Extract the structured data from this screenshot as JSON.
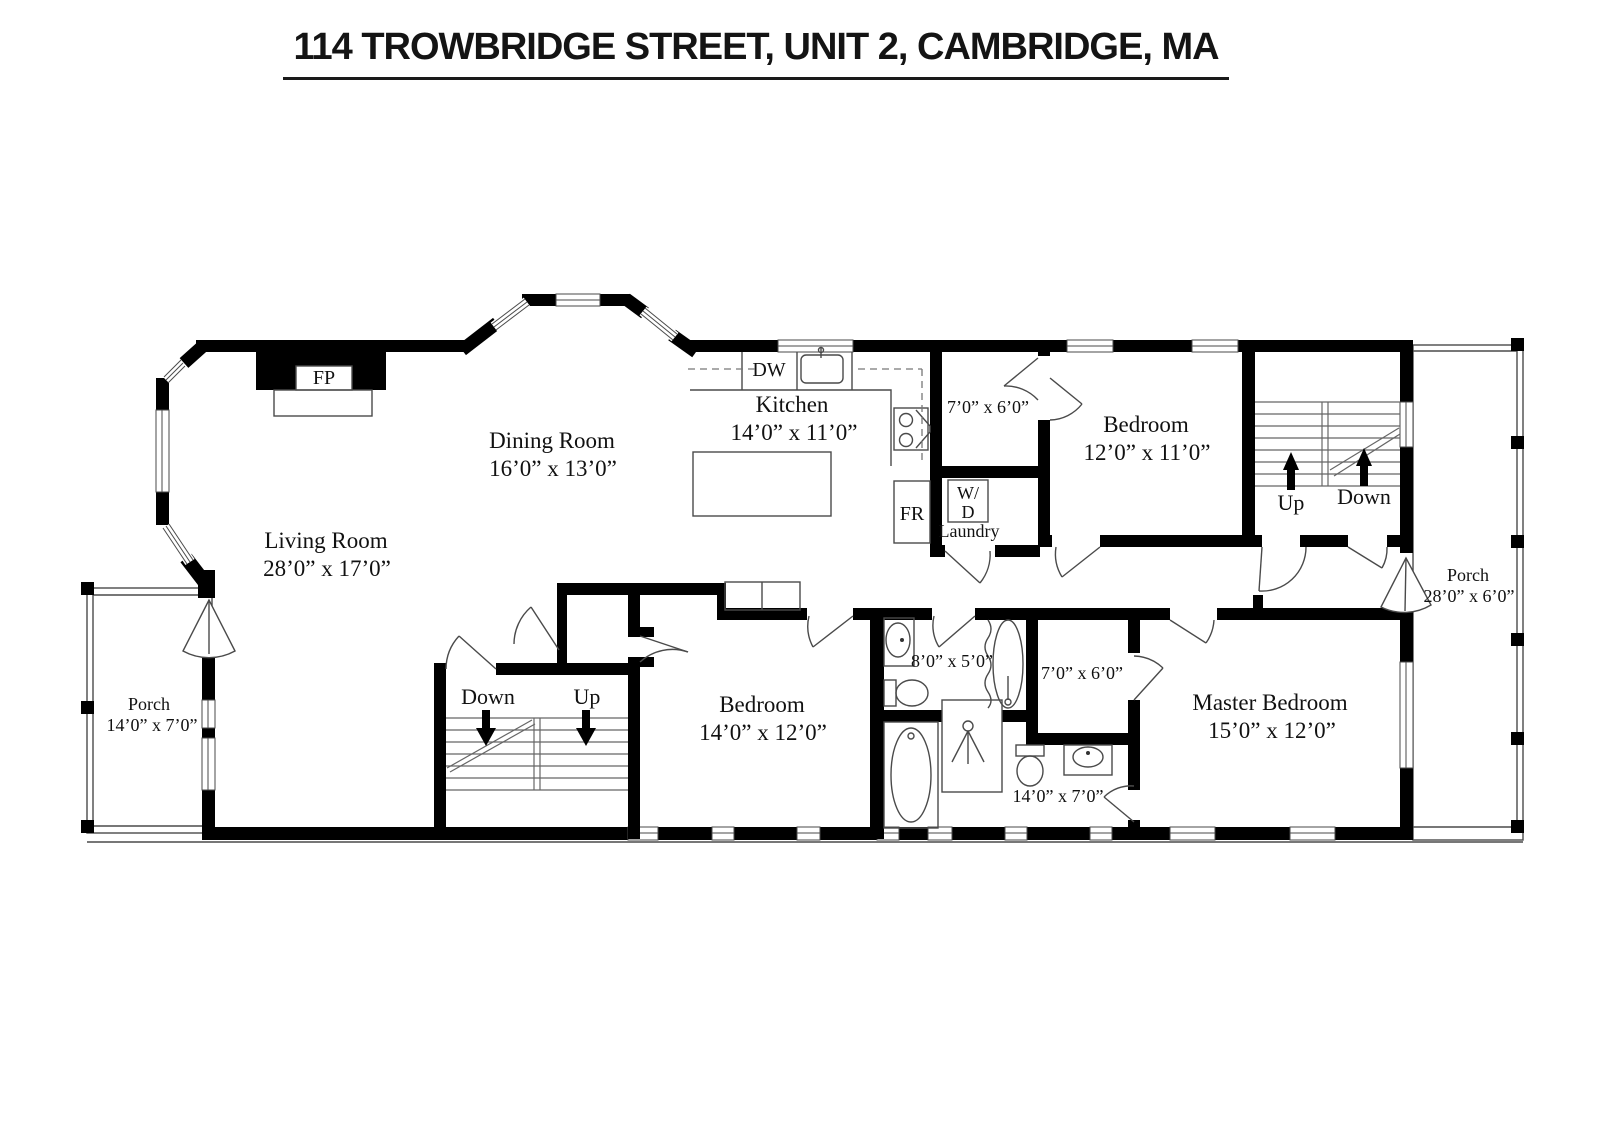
{
  "title": "114 TROWBRIDGE STREET, UNIT 2, CAMBRIDGE, MA",
  "rooms": {
    "living_room": {
      "name": "Living Room",
      "dims": "28’0” x 17’0”"
    },
    "dining_room": {
      "name": "Dining  Room",
      "dims": "16’0” x 13’0”"
    },
    "kitchen": {
      "name": "Kitchen",
      "dims": "14’0” x 11’0”"
    },
    "bedroom_upper": {
      "name": "Bedroom",
      "dims": "12’0” x 11’0”"
    },
    "bedroom_lower": {
      "name": "Bedroom",
      "dims": "14’0” x 12’0”"
    },
    "master_bedroom": {
      "name": "Master Bedroom",
      "dims": "15’0” x 12’0”"
    },
    "porch_left": {
      "name": "Porch",
      "dims": "14’0” x 7’0”"
    },
    "porch_right": {
      "name": "Porch",
      "dims": "28’0” x 6’0”"
    },
    "bathroom": {
      "dims": "8’0” x 5’0”"
    },
    "closet_upper": {
      "dims": "7’0” x 6’0”"
    },
    "master_closet": {
      "dims": "7’0” x 6’0”"
    },
    "master_bathroom": {
      "dims": "14’0” x 7’0”"
    },
    "laundry": {
      "name": "Laundry"
    }
  },
  "labels": {
    "fireplace": "FP",
    "dishwasher": "DW",
    "refrigerator": "FR",
    "washer_dryer_line1": "W/",
    "washer_dryer_line2": "D",
    "up": "Up",
    "down": "Down"
  },
  "colors": {
    "wall": "#000000",
    "line": "#4a4a4a",
    "background": "#ffffff",
    "text": "#111111"
  }
}
